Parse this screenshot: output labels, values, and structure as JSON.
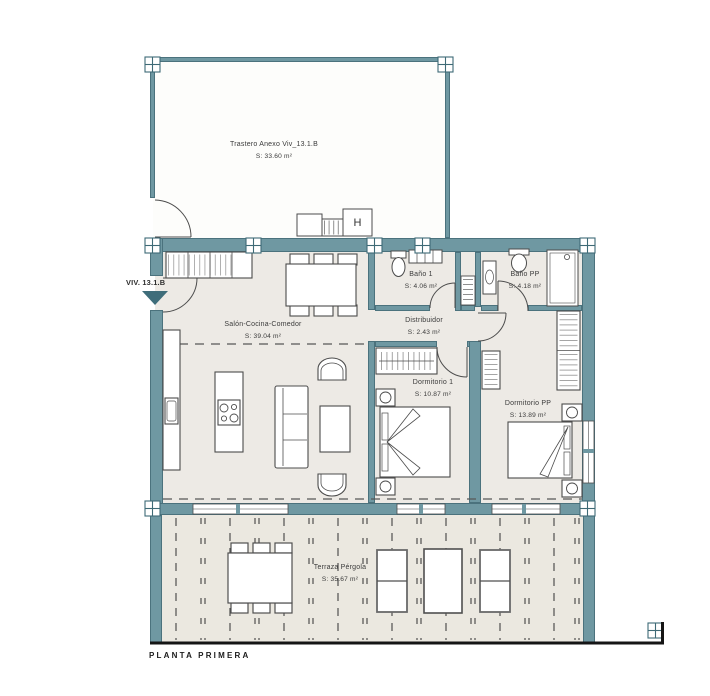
{
  "title_block": {
    "plan_name": "PLANTA PRIMERA"
  },
  "entrance": {
    "unit_label": "VIV. 13.1.B"
  },
  "rooms": {
    "trastero": {
      "name": "Trastero Anexo Viv_13.1.B",
      "area": "S: 33.60 m²"
    },
    "salon": {
      "name": "Salón-Cocina-Comedor",
      "area": "S: 39.04 m²"
    },
    "bano1": {
      "name": "Baño 1",
      "area": "S: 4.06 m²"
    },
    "bano_pp": {
      "name": "Baño PP",
      "area": "S: 4.18 m²"
    },
    "distribuidor": {
      "name": "Distribuidor",
      "area": "S: 2.43 m²"
    },
    "dormitorio1": {
      "name": "Dormitorio 1",
      "area": "S: 10.87 m²"
    },
    "dormitorio_pp": {
      "name": "Dormitorio PP",
      "area": "S: 13.89 m²"
    },
    "terraza": {
      "name": "Terraza Pérgola",
      "area": "S: 35.67 m²"
    }
  },
  "annotations": {
    "elevator_label": "H"
  },
  "colors": {
    "wall_teal": "#6f98a2",
    "wall_outline": "#3e6a76",
    "floor": "#edeae5",
    "terrace_floor": "#ebe8e0",
    "line_dark": "#4c4c4c",
    "frame_black": "#151515",
    "text": "#3b3b3b"
  }
}
